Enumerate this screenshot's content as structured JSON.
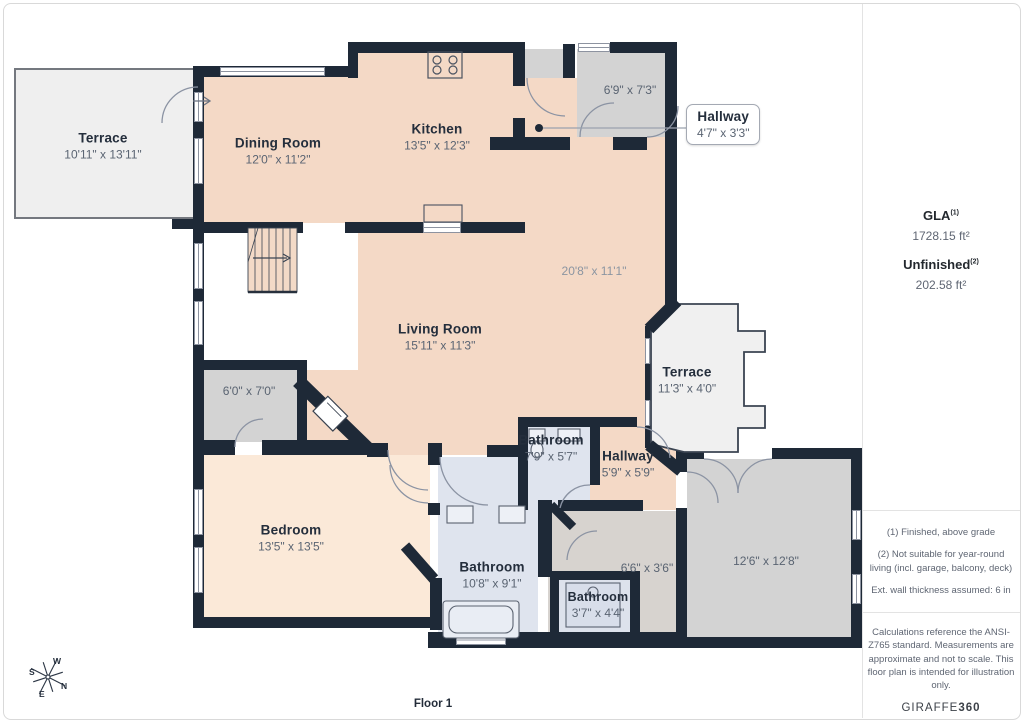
{
  "floorplan": {
    "floor_label": "Floor 1",
    "rooms": {
      "terrace_top": {
        "label": "Terrace",
        "dims": "10'11\" x 13'11\""
      },
      "dining_room": {
        "label": "Dining Room",
        "dims": "12'0\" x 11'2\""
      },
      "kitchen": {
        "label": "Kitchen",
        "dims": "13'5\" x 12'3\""
      },
      "entry": {
        "dims": "6'9\" x 7'3\""
      },
      "hallway_top": {
        "label": "Hallway",
        "dims": "4'7\" x 3'3\""
      },
      "living_room": {
        "label": "Living Room",
        "dims": "15'11\" x 11'3\"",
        "overall_dims": "20'8\" x 11'1\""
      },
      "terrace_right": {
        "label": "Terrace",
        "dims": "11'3\" x 4'0\""
      },
      "bathroom_top": {
        "label": "Bathroom",
        "dims": "7'9\" x 5'7\""
      },
      "hallway_mid": {
        "label": "Hallway",
        "dims": "5'9\" x 5'9\""
      },
      "closet": {
        "dims": "6'0\" x 7'0\""
      },
      "bedroom": {
        "label": "Bedroom",
        "dims": "13'5\" x 13'5\""
      },
      "bathroom_main": {
        "label": "Bathroom",
        "dims": "10'8\" x 9'1\""
      },
      "bathroom_small": {
        "label": "Bathroom",
        "dims": "3'7\" x 4'4\""
      },
      "storage": {
        "dims": "6'6\" x 3'6\""
      },
      "garage": {
        "dims": "12'6\" x 12'8\""
      }
    },
    "compass": {
      "n": "N",
      "s": "S",
      "e": "E",
      "w": "W"
    }
  },
  "sidebar": {
    "gla_label": "GLA",
    "gla_sup": "(1)",
    "gla_value": "1728.15 ft²",
    "unfinished_label": "Unfinished",
    "unfinished_sup": "(2)",
    "unfinished_value": "202.58 ft²",
    "notes": [
      "(1) Finished, above grade",
      "(2) Not suitable for year-round living (incl. garage, balcony, deck)",
      "Ext. wall thickness assumed: 6 in"
    ],
    "disclaimer": "Calculations reference the ANSI-Z765 standard. Measurements are approximate and not to scale. This floor plan is intended for illustration only.",
    "brand": "GIRAFFE",
    "brand_bold": "360"
  }
}
